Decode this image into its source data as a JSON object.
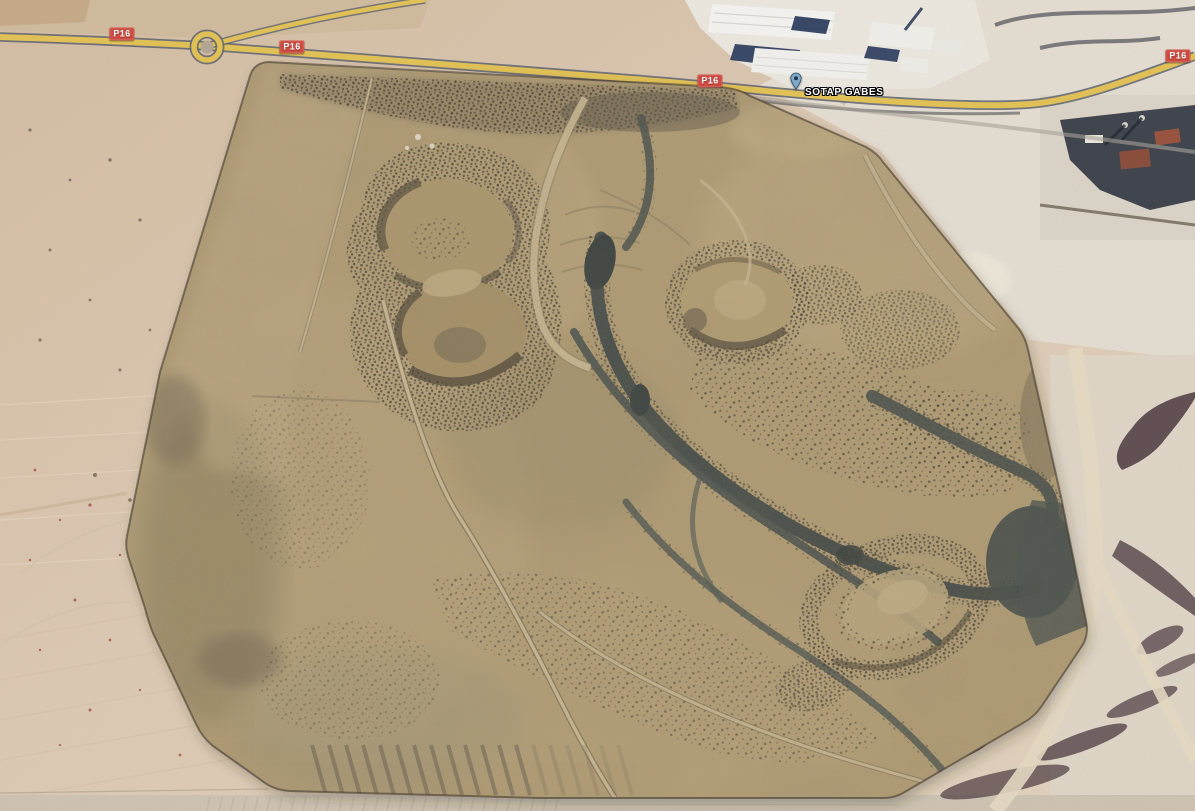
{
  "roads": {
    "badges": [
      {
        "label": "P16"
      },
      {
        "label": "P16"
      },
      {
        "label": "P16"
      },
      {
        "label": "P16"
      }
    ]
  },
  "marker": {
    "label": "SOTAP GABES",
    "icon": "place-pin-icon"
  },
  "colors": {
    "road_fill": "#e6c554",
    "road_casing": "#5a6070",
    "badge_background": "#cd4b41",
    "badge_text": "#ffffff",
    "marker_pin": "#7fa8c9",
    "marker_label_fill": "#ffffff",
    "marker_label_outline": "#000000",
    "overlay_terrain": "#b7a176",
    "base_sand": "#dcc7b0",
    "channel_water": "#3a4443",
    "industrial_shadow": "#22335a",
    "gully_shadow": "#46333c"
  }
}
